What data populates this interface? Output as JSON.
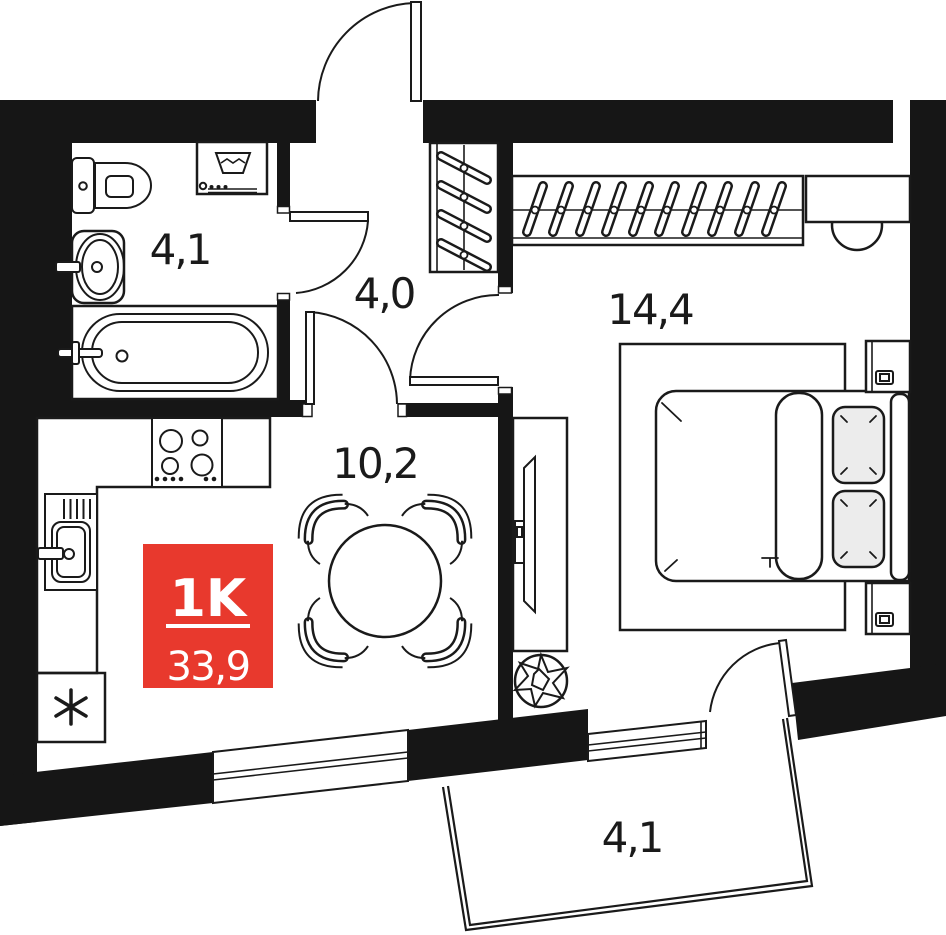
{
  "plan": {
    "badge": {
      "unit_type": "1K",
      "area": "33,9",
      "bg_color": "#e8392d",
      "text_color": "#ffffff"
    },
    "rooms": {
      "bathroom": {
        "area_label": "4,1"
      },
      "hallway": {
        "area_label": "4,0"
      },
      "bedroom": {
        "area_label": "14,4"
      },
      "kitchen_living": {
        "area_label": "10,2"
      },
      "balcony": {
        "area_label": "4,1"
      }
    },
    "colors": {
      "wall": "#161616",
      "line": "#1a1a1a",
      "pillow": "#ececec",
      "background": "#ffffff",
      "badge_red": "#e8392d"
    }
  }
}
